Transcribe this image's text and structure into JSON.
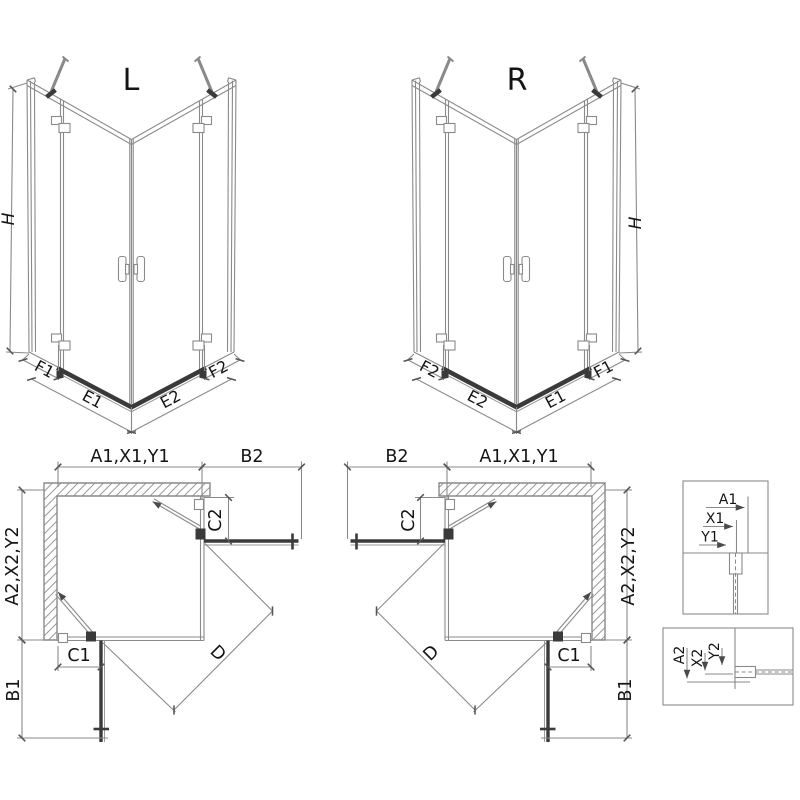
{
  "diagram_type": "shower-enclosure-technical-drawing",
  "isometric": {
    "left": {
      "title": "L"
    },
    "right": {
      "title": "R"
    },
    "height_label": "H",
    "bottom_dims": {
      "f1": "F1",
      "e1": "E1",
      "e2": "E2",
      "f2": "F2"
    }
  },
  "plan": {
    "wall_top_width": "A1,X1,Y1",
    "top_panel_width": "B2",
    "top_panel_inset": "C2",
    "wall_side_width": "A2,X2,Y2",
    "bottom_panel_inset": "C1",
    "bottom_panel_width": "B1",
    "diagonal_entry": "D"
  },
  "detail_top": {
    "dim_a": "A1",
    "dim_x": "X1",
    "dim_y": "Y1"
  },
  "detail_bottom": {
    "dim_a": "A2",
    "dim_x": "X2",
    "dim_y": "Y2"
  },
  "colors": {
    "line": "#8a8a8a",
    "dark": "#3a3a3a",
    "text": "#141414",
    "hatch": "#9a9a9a",
    "background": "#ffffff"
  }
}
